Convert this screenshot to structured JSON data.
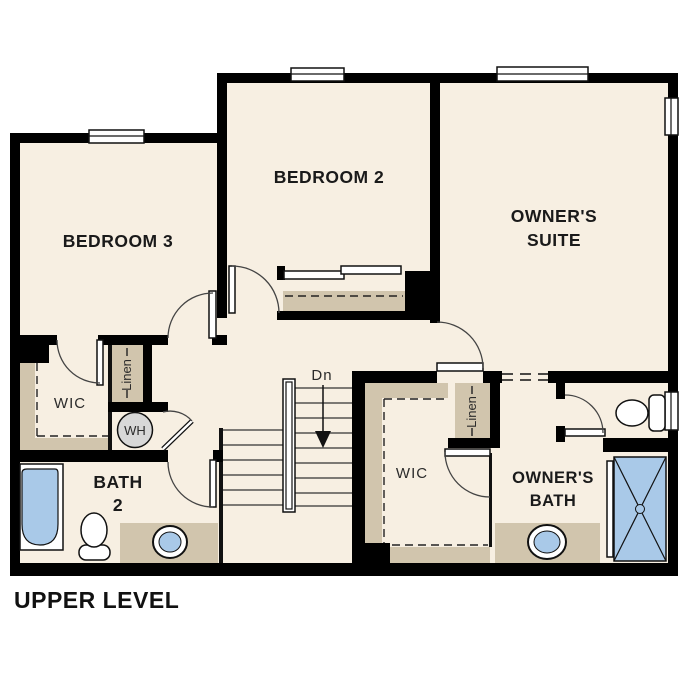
{
  "plan": {
    "title": "UPPER LEVEL",
    "colors": {
      "wall": "#000000",
      "floor": "#f7efe2",
      "casework": "#d1c5ad",
      "water": "#a9c9e8",
      "appliance": "#d8d8d8"
    },
    "labels": {
      "bedroom3": "BEDROOM 3",
      "bedroom2": "BEDROOM 2",
      "owners_suite_line1": "OWNER'S",
      "owners_suite_line2": "SUITE",
      "bath2_line1": "BATH",
      "bath2_line2": "2",
      "owners_bath_line1": "OWNER'S",
      "owners_bath_line2": "BATH",
      "wic_left": "WIC",
      "wic_right": "WIC",
      "linen_left": "Linen",
      "linen_right": "Linen",
      "water_heater": "WH",
      "stairs_down": "Dn"
    },
    "fixtures": [
      "bathtub",
      "toilet",
      "sink",
      "water-heater",
      "shower",
      "toilet-owners",
      "sink-owners"
    ]
  }
}
